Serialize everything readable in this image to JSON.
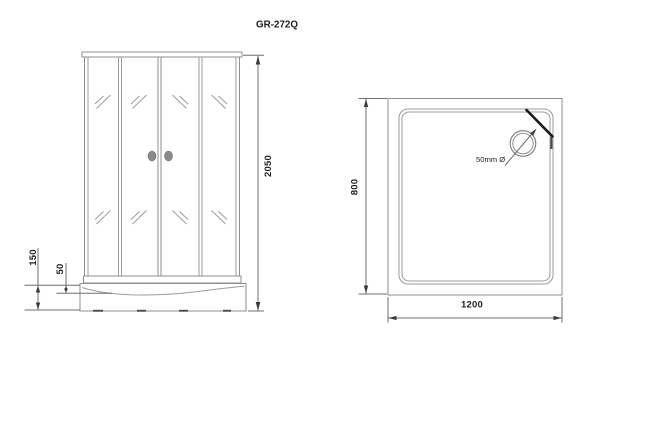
{
  "title": "GR-272Q",
  "front_view": {
    "dim_height": "2050",
    "dim_tray_height": "150",
    "dim_tray_lip": "50"
  },
  "top_view": {
    "dim_width": "1200",
    "dim_depth": "800",
    "drain_label": "50mm Ø"
  },
  "colors": {
    "background": "#ffffff",
    "line": "#8f8f8f",
    "dimension_line": "#6f6f6f",
    "text": "#1f1f1f",
    "handle_fill": "#8a8a8a",
    "corner_panel": "#1a1a1a"
  }
}
